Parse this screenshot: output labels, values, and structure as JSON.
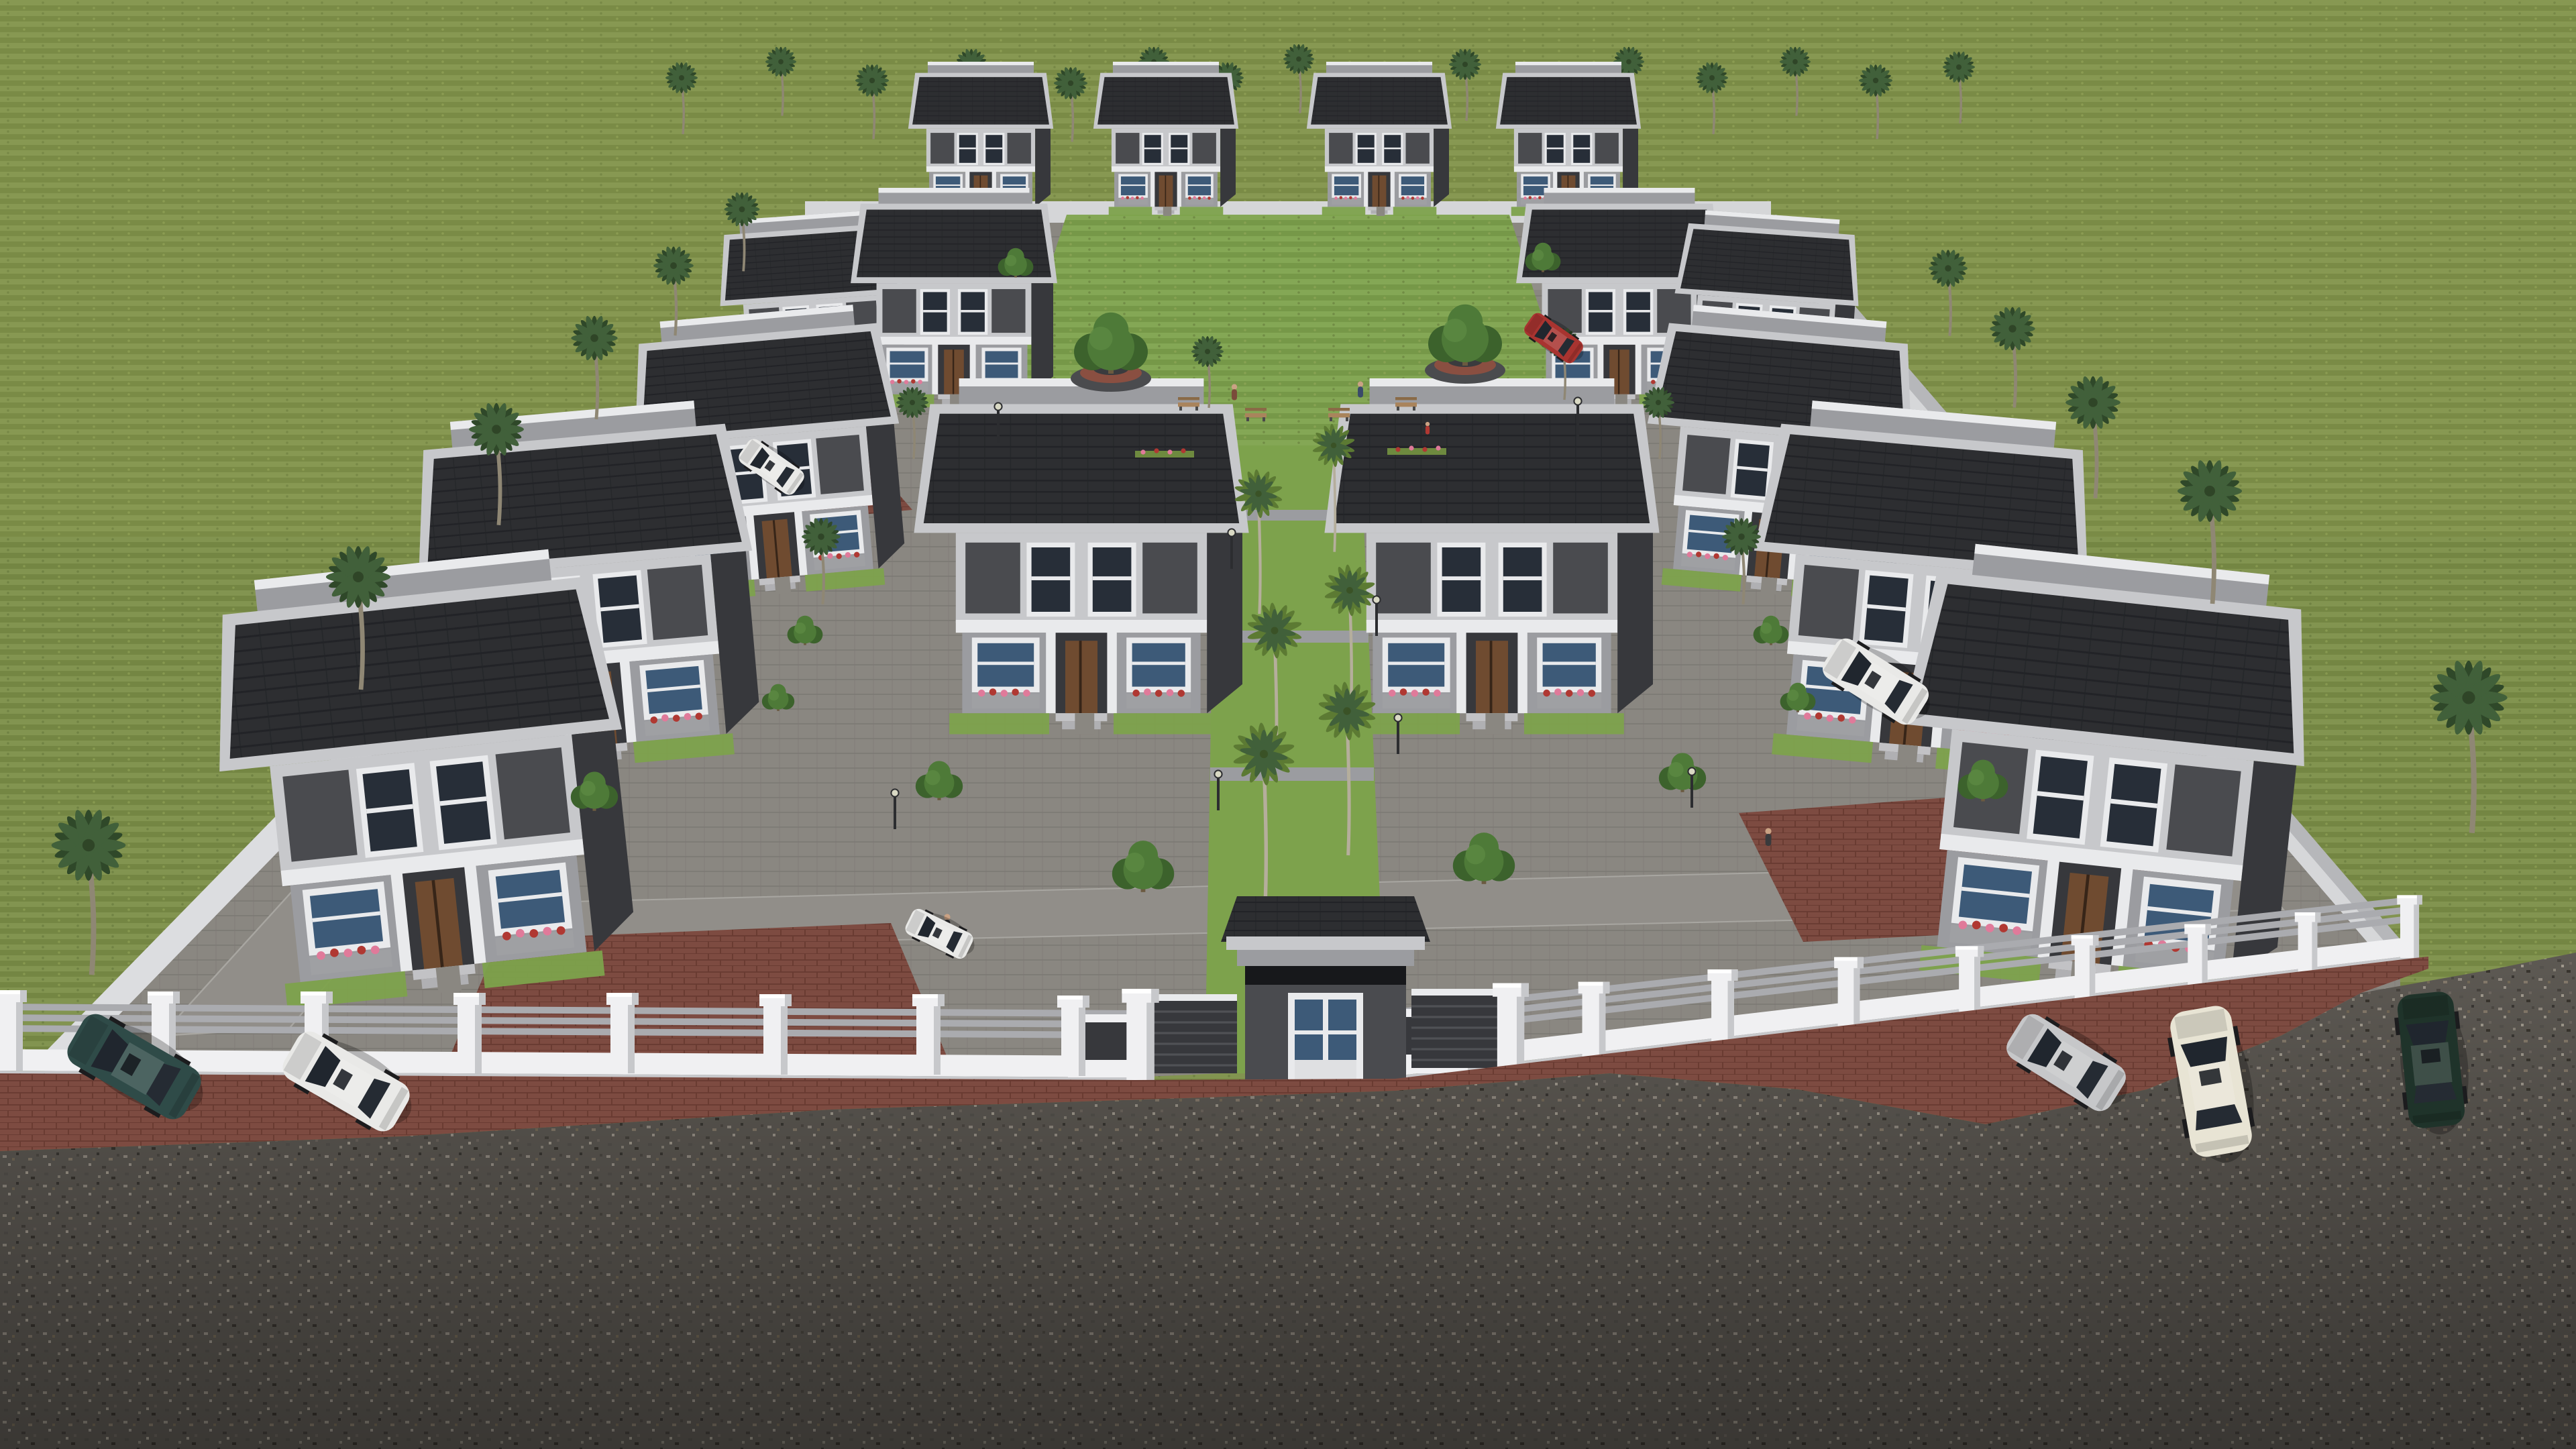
{
  "scene": {
    "type": "3d-architectural-aerial-render",
    "description": "Bird's-eye 3D visualization of a gated residential villa estate set in a large open lawn. Rows of modern two-storey villas with charcoal tiled roofs and grey/white facades surround a central landscaped park; a palm-lined axis leads to a front gatehouse in a white perimeter fence; cars are parked on a gravel road outside.",
    "environment": {
      "ground": "olive-green lawn surrounding the walled estate",
      "foreground": "dark gravel road with red-brown brick aprons along the fence",
      "weather": "overcast daylight, soft shadows",
      "sky_visible": false
    },
    "estate": {
      "perimeter": "white fence with square pillars, triple grey rails and low white base wall; solid grey boundary walls on the receding sides",
      "gatehouse": "small charcoal guard house with hipped dark-tile roof, grey fascia and white-framed glass double door, flanked by dark sliding gate panels and white gate posts",
      "villas_count": 18,
      "villa_style": "flat-sloped charcoal tile roof, light grey parapets and trim, charcoal accent panels, white framed windows, timber entrance door, flower boxes with pink and red blooms, front steps and small lawns",
      "central_park": "lawn with two round two-tier planters holding large trees, benches with seated people, street lamps and shrubs",
      "central_axis": "green walkway flanked by tall royal palms with paved crossing steps leading from the park to the gatehouse"
    },
    "vegetation": {
      "palm_trees_perimeter": 28,
      "royal_palms_axis": 8,
      "deciduous_trees": 14,
      "hedges_and_flowerbeds": true
    },
    "vehicles": [
      {
        "id": "suv-dark-teal",
        "color_key": "car_teal",
        "location": "outside fence, far left, parked on brick apron"
      },
      {
        "id": "hatchback-white",
        "color_key": "car_white",
        "location": "outside fence, left of gate"
      },
      {
        "id": "hatchback-silver",
        "color_key": "car_silver",
        "location": "outside fence, right side"
      },
      {
        "id": "sedan-cream",
        "color_key": "car_cream",
        "location": "outside fence, right side, nose toward viewer"
      },
      {
        "id": "sportscar-dark-green",
        "color_key": "car_green",
        "location": "outside fence, far right on gravel"
      },
      {
        "id": "suv-white",
        "color_key": "car_white",
        "location": "inside fence, right front yard driveway"
      },
      {
        "id": "compact-red",
        "color_key": "car_red",
        "location": "inside estate, near park on right inner road"
      },
      {
        "id": "car-white-driveway",
        "color_key": "car_white",
        "location": "inside estate, left inner road near villa"
      },
      {
        "id": "car-white-front",
        "color_key": "car_white",
        "location": "inside estate, left of central walkway near fence"
      }
    ],
    "people": [
      {
        "location": "central park bench, seated"
      },
      {
        "location": "central park bench, seated"
      },
      {
        "location": "central park lawn, child standing"
      },
      {
        "location": "left inner walkway, walking"
      },
      {
        "location": "right inner road, walking"
      }
    ]
  },
  "palette": {
    "grass": "#7b8e47",
    "grass_hi": "#8ba050",
    "park_lawn": "#7da24c",
    "pavement": "#8a8781",
    "cobble_line": "#7b7873",
    "road": "#5d5953",
    "road_dark": "#403d38",
    "brick": "#7d4b41",
    "brick_line": "#683a31",
    "fence_white": "#f0f0f2",
    "fence_shade": "#c7c8cb",
    "rail": "#aaabaf",
    "wall_light": "#c7c8cb",
    "wall_mid": "#9b9ca0",
    "wall_dark": "#4a4b4f",
    "wall_darker": "#37383c",
    "trim": "#e9eaec",
    "roof": "#2d2e31",
    "roof_line": "#222327",
    "glass": "#272e38",
    "glass_blue": "#3d5a78",
    "door": "#6f4b30",
    "frond": "#41603a",
    "frond_dark": "#2f4829",
    "trunk": "#8f8774",
    "trunk_tall": "#b5ae9c",
    "tree": "#4e7a38",
    "tree_dark": "#3c622c",
    "planter": "#4a4b4e",
    "planter_brick": "#8a4f41",
    "lamp": "#2c2d30",
    "flower_pink": "#e07a9a",
    "flower_red": "#b03832",
    "car_teal": "#2f4b48",
    "car_white": "#e9e9e7",
    "car_silver": "#c6c7c9",
    "car_cream": "#e8e4d4",
    "car_green": "#1f332a",
    "car_red": "#a83430"
  }
}
